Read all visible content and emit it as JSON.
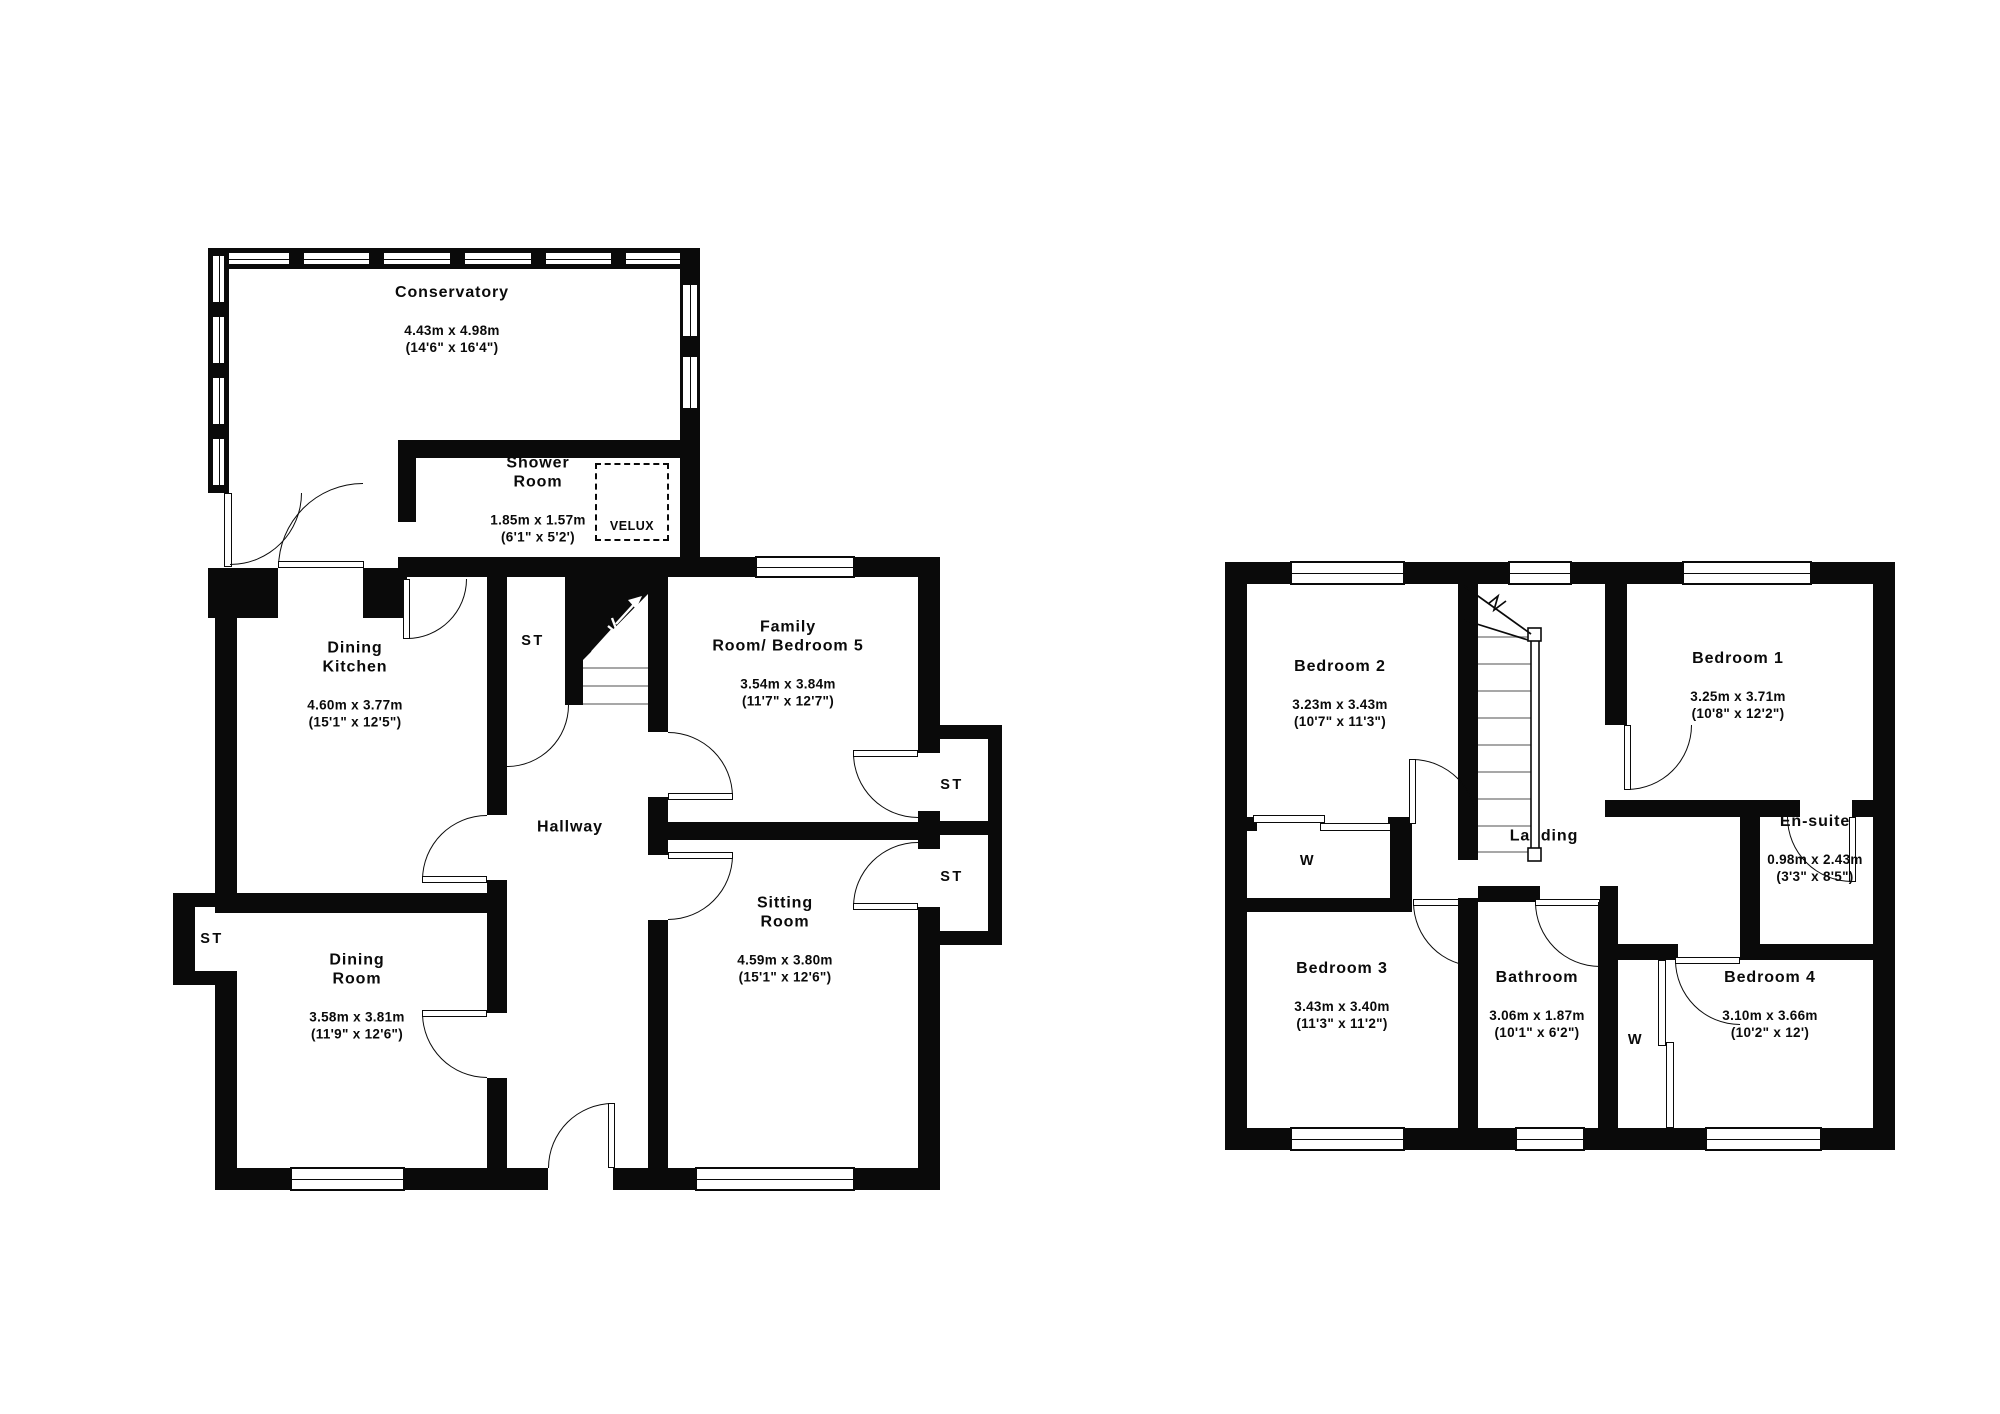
{
  "ground_floor": {
    "rooms": [
      {
        "name": "Conservatory",
        "dims": "4.43m x 4.98m\n(14'6\" x 16'4\")"
      },
      {
        "name": "Shower\nRoom",
        "dims": "1.85m x 1.57m\n(6'1\" x 5'2')"
      },
      {
        "name": "Dining\nKitchen",
        "dims": "4.60m x 3.77m\n(15'1\" x 12'5\")"
      },
      {
        "name": "Family\nRoom/ Bedroom 5",
        "dims": "3.54m x 3.84m\n(11'7\" x 12'7\")"
      },
      {
        "name": "Hallway",
        "dims": ""
      },
      {
        "name": "Sitting\nRoom",
        "dims": "4.59m x 3.80m\n(15'1\" x 12'6\")"
      },
      {
        "name": "Dining\nRoom",
        "dims": "3.58m x 3.81m\n(11'9\" x 12'6\")"
      }
    ],
    "storage_label": "ST",
    "velux_label": "VELUX"
  },
  "first_floor": {
    "rooms": [
      {
        "name": "Bedroom 2",
        "dims": "3.23m x 3.43m\n(10'7\" x 11'3\")"
      },
      {
        "name": "Bedroom 1",
        "dims": "3.25m x 3.71m\n(10'8\" x 12'2\")"
      },
      {
        "name": "Landing",
        "dims": ""
      },
      {
        "name": "En-suite",
        "dims": "0.98m x 2.43m\n(3'3\" x 8'5\")"
      },
      {
        "name": "Bedroom 3",
        "dims": "3.43m x 3.40m\n(11'3\" x 11'2\")"
      },
      {
        "name": "Bathroom",
        "dims": "3.06m x 1.87m\n(10'1\" x 6'2\")"
      },
      {
        "name": "Bedroom 4",
        "dims": "3.10m x 3.66m\n(10'2\" x 12')"
      }
    ],
    "wardrobe_label": "W"
  },
  "colors": {
    "ink": "#0a0a0a",
    "paper": "#ffffff"
  }
}
